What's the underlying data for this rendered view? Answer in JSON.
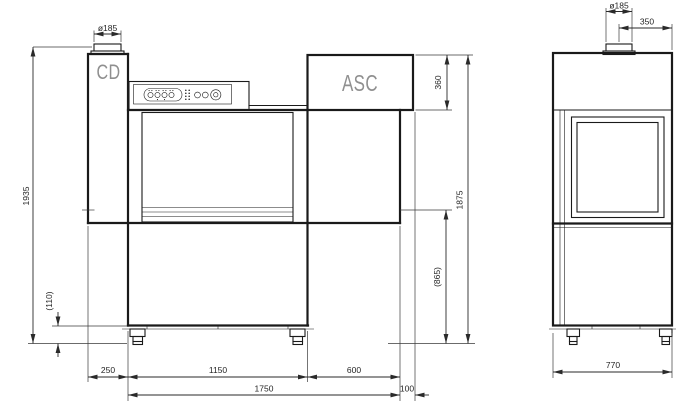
{
  "drawing": {
    "type": "technical-drawing",
    "views": [
      "front-elevation",
      "side-elevation"
    ],
    "labels": {
      "cd": "CD",
      "asc": "ASC"
    },
    "front_view": {
      "dims": {
        "chimney_diameter": "ø185",
        "overall_height": "1935",
        "base_height": "(110)",
        "infeed_offset": "250",
        "cabinet_width": "1150",
        "outfeed_width": "600",
        "frame_length": "1750",
        "asc_overhang": "100",
        "asc_height": "360",
        "body_height": "1875",
        "belt_height": "(865)"
      }
    },
    "side_view": {
      "dims": {
        "chimney_diameter": "ø185",
        "chimney_offset": "350",
        "depth": "770"
      }
    },
    "colors": {
      "line": "#1a1a1a",
      "label_gray": "#8f8f8f",
      "dim_text": "#242424",
      "background": "#ffffff"
    }
  }
}
